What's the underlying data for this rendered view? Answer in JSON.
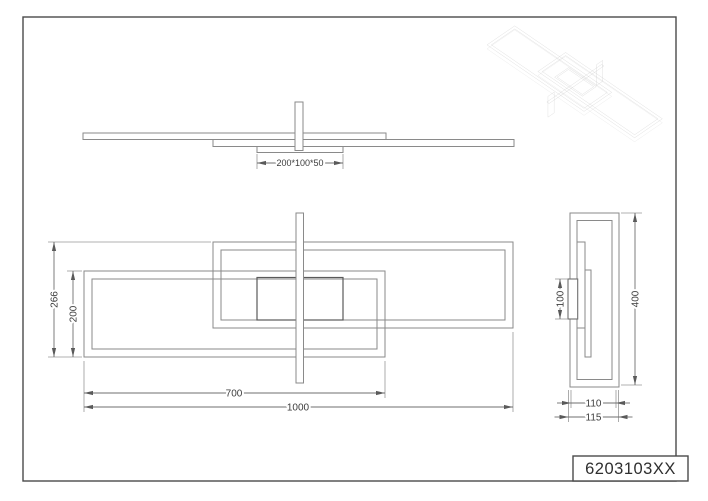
{
  "colors": {
    "background": "#ffffff",
    "drawing_line": "#8a8a8a",
    "dark_line": "#5a5a5a",
    "dimension_line": "#6f6f6f",
    "text": "#3d3d3d",
    "border": "#4a4a4a"
  },
  "front_view": {
    "canopy_size": "200*100*50"
  },
  "plan_view": {
    "total_depth": "266",
    "frame_depth": "200",
    "frame_length": "700",
    "total_length": "1000"
  },
  "side_view": {
    "canopy_height": "100",
    "fixture_height": "400",
    "body_width": "110",
    "total_width": "115"
  },
  "title_block": {
    "part_number": "6203103XX"
  }
}
